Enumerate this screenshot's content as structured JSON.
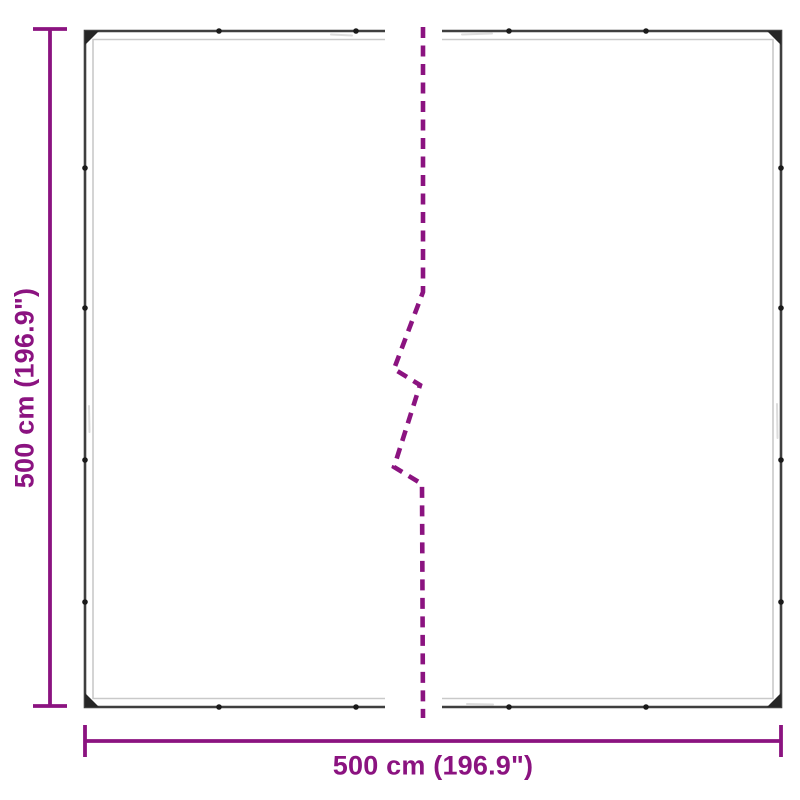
{
  "labels": {
    "width": "500 cm (196.9\")",
    "height": "500 cm (196.9\")"
  },
  "colors": {
    "accent": "#8B1380",
    "tarp_border": "#3F3F3F",
    "tarp_inner": "#C9C9C9",
    "grommet": "#1A1A1A",
    "corner": "#262626",
    "wrinkle": "#DCDCDC",
    "bg": "#FFFFFF"
  },
  "icons": {
    "grommet": "small black eyelet dot on tarp hem",
    "corner_patch": "black triangular corner reinforcement",
    "break_line": "purple dashed vertical break (continuation) line"
  }
}
